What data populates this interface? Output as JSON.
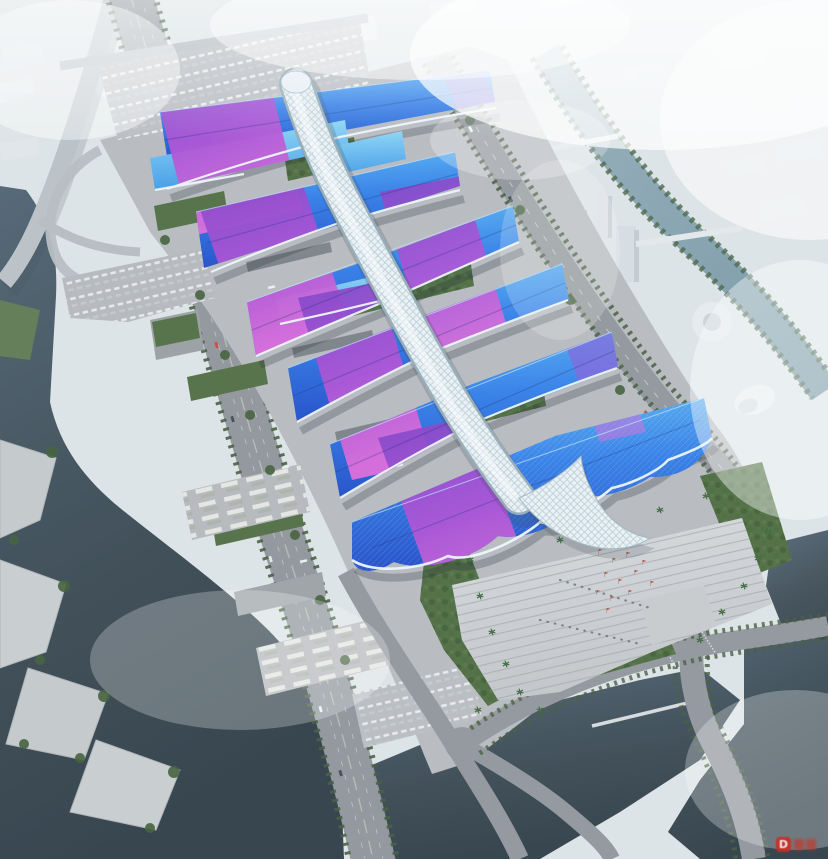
{
  "scene": {
    "kind": "architectural aerial rendering",
    "subject": "international exhibition and convention center",
    "view": "bird's-eye perspective with haze"
  },
  "watermark": {
    "letter": "D",
    "badge_color": "#cf2b20",
    "glyph_color": "#c43a2e"
  },
  "palette": {
    "sky_haze": "#eef2f5",
    "city_block": "#e3e8ec",
    "ground_apron": "#b6b9be",
    "plaza": "#cbced2",
    "walkway": "#c6cacd",
    "road": "#8f9499",
    "road_light": "#b9bfc5",
    "boulevard": "#8e939a",
    "water_dark": "#36454f",
    "water_canal": "#7e9aa8",
    "roof_blue_deep": "#1b49c8",
    "roof_blue": "#2f7de9",
    "roof_blue_light": "#57b4f2",
    "roof_cyan": "#7fd0f5",
    "ribbon_purple": "#7b3cc6",
    "ribbon_magenta": "#dd66da",
    "spine_white": "#e9f1f5",
    "spine_shadow": "#93a9b4",
    "green_roof": "#4a6a3c",
    "tree_green": "#3c5a34",
    "lawn": "#5d7750",
    "flag_red": "#d03a30",
    "shadow": "#1c242e"
  }
}
